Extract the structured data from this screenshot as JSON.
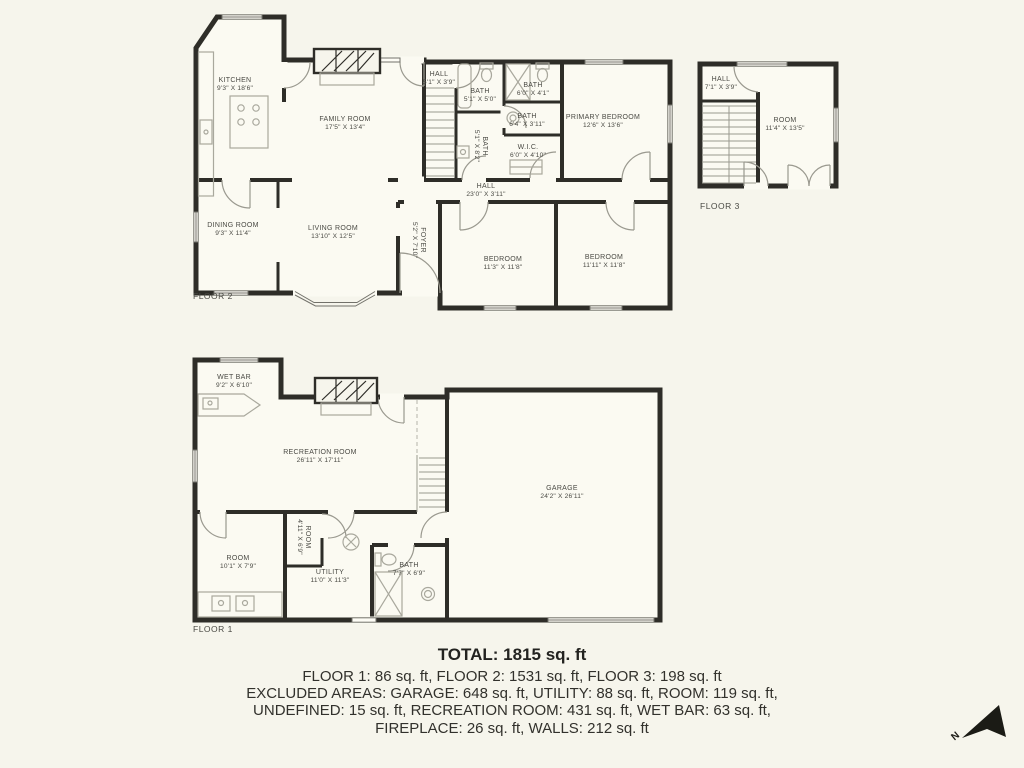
{
  "floor2": {
    "label": "FLOOR 2",
    "rooms": {
      "kitchen": {
        "name": "KITCHEN",
        "dims": "9'3\" X 18'6\""
      },
      "family_room": {
        "name": "FAMILY ROOM",
        "dims": "17'5\" X 13'4\""
      },
      "hall_top": {
        "name": "HALL",
        "dims": "5'1\" X 3'9\""
      },
      "bath_a": {
        "name": "BATH",
        "dims": "5'1\" X 5'0\""
      },
      "bath_b": {
        "name": "BATH",
        "dims": "6'0\" X 4'1\""
      },
      "bath_c": {
        "name": "BATH",
        "dims": "6'4\" X 3'11\""
      },
      "bath_d": {
        "name": "BATH",
        "dims": "5'1\" X 8'2\""
      },
      "primary_bedroom": {
        "name": "PRIMARY BEDROOM",
        "dims": "12'6\" X 13'6\""
      },
      "wic": {
        "name": "W.I.C.",
        "dims": "6'0\" X 4'10\""
      },
      "hall": {
        "name": "HALL",
        "dims": "23'0\" X 3'11\""
      },
      "dining_room": {
        "name": "DINING ROOM",
        "dims": "9'3\" X 11'4\""
      },
      "living_room": {
        "name": "LIVING ROOM",
        "dims": "13'10\" X 12'5\""
      },
      "foyer": {
        "name": "FOYER",
        "dims": "5'2\" X 7'10\""
      },
      "bedroom_a": {
        "name": "BEDROOM",
        "dims": "11'3\" X 11'8\""
      },
      "bedroom_b": {
        "name": "BEDROOM",
        "dims": "11'11\" X 11'8\""
      }
    }
  },
  "floor3": {
    "label": "FLOOR 3",
    "rooms": {
      "hall": {
        "name": "HALL",
        "dims": "7'1\" X 3'9\""
      },
      "room": {
        "name": "ROOM",
        "dims": "11'4\" X 13'5\""
      }
    }
  },
  "floor1": {
    "label": "FLOOR 1",
    "rooms": {
      "wet_bar": {
        "name": "WET BAR",
        "dims": "9'2\" X 6'10\""
      },
      "recreation_room": {
        "name": "RECREATION ROOM",
        "dims": "26'11\" X 17'11\""
      },
      "garage": {
        "name": "GARAGE",
        "dims": "24'2\" X 26'11\""
      },
      "room_small": {
        "name": "ROOM",
        "dims": "4'11\" X 6'9\""
      },
      "room": {
        "name": "ROOM",
        "dims": "10'1\" X 7'9\""
      },
      "utility": {
        "name": "UTILITY",
        "dims": "11'0\" X 11'3\""
      },
      "bath": {
        "name": "BATH",
        "dims": "7'7\" X 6'9\""
      }
    }
  },
  "summary": {
    "total": "TOTAL: 1815 sq. ft",
    "lines": [
      "FLOOR 1: 86 sq. ft, FLOOR 2: 1531 sq. ft, FLOOR 3: 198 sq. ft",
      "EXCLUDED AREAS: GARAGE: 648 sq. ft, UTILITY: 88 sq. ft, ROOM: 119 sq. ft,",
      "UNDEFINED: 15 sq. ft, RECREATION ROOM: 431 sq. ft, WET BAR: 63 sq. ft,",
      "FIREPLACE: 26 sq. ft, WALLS: 212 sq. ft"
    ]
  },
  "compass": {
    "label": "N"
  }
}
